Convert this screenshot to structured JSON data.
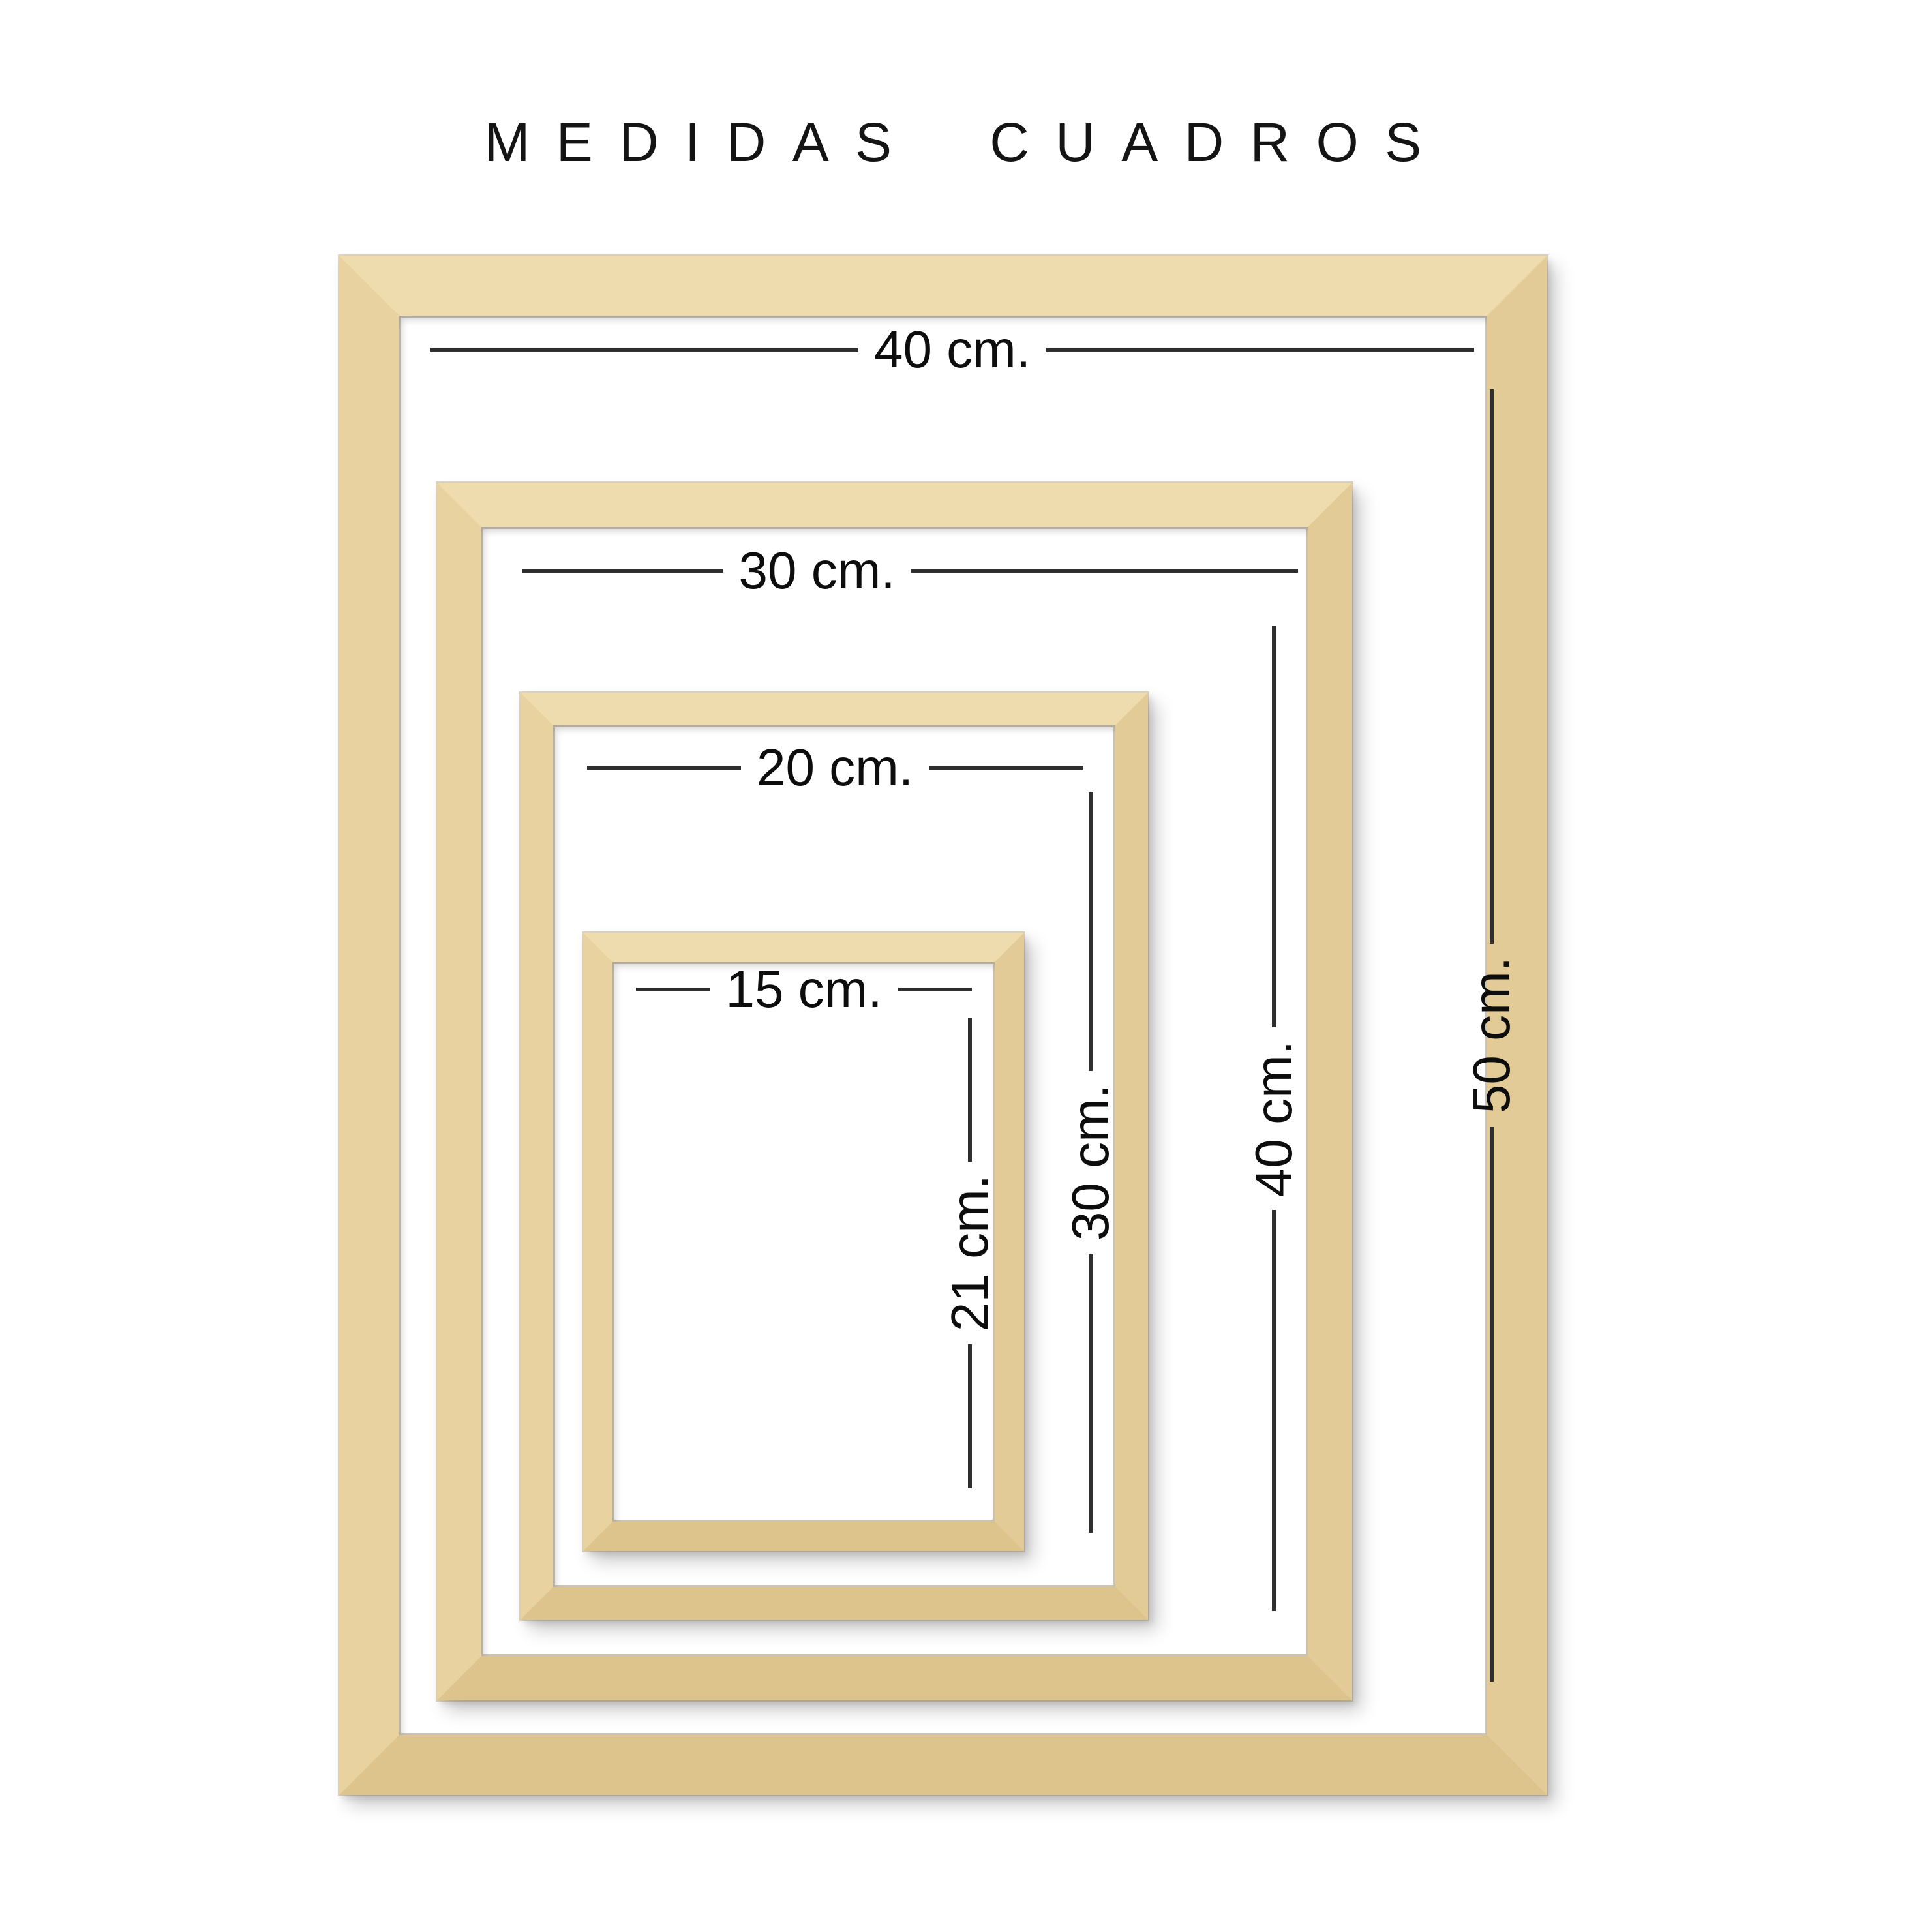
{
  "title": "MEDIDAS CUADROS",
  "colors": {
    "background": "#ffffff",
    "wood": "#e8d2a0",
    "wood_highlight": "#eedcae",
    "wood_shadow": "#ddc48c",
    "dimension_line": "#2f2f2f",
    "text": "#0d0d0d"
  },
  "frames": [
    {
      "id": "40x50",
      "width_label": "40 cm.",
      "height_label": "50 cm."
    },
    {
      "id": "30x40",
      "width_label": "30 cm.",
      "height_label": "40 cm."
    },
    {
      "id": "20x30",
      "width_label": "20 cm.",
      "height_label": "30 cm."
    },
    {
      "id": "15x21",
      "width_label": "15 cm.",
      "height_label": "21 cm."
    }
  ]
}
